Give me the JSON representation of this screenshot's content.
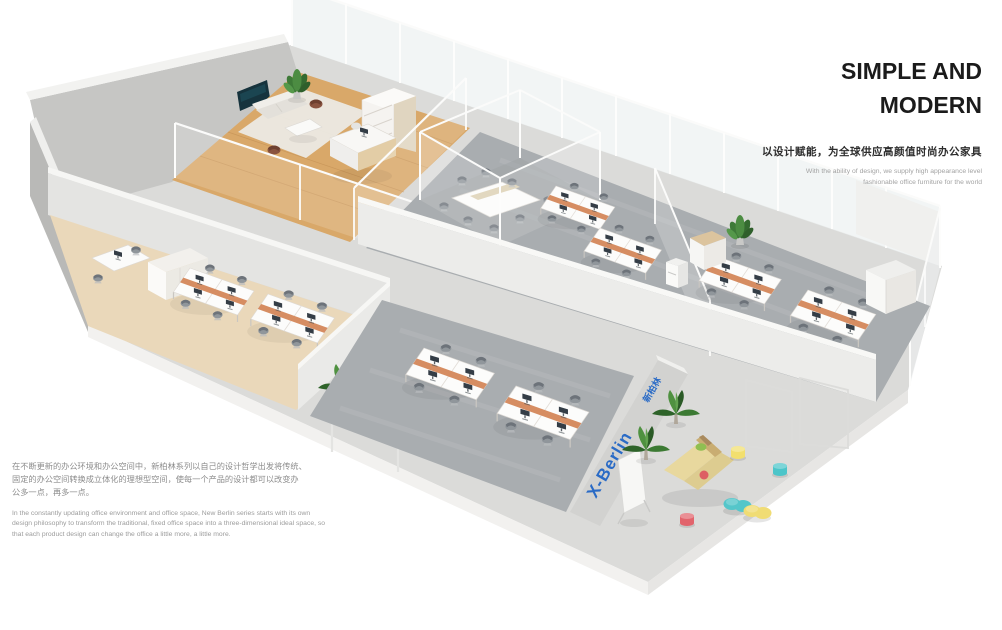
{
  "header": {
    "title_line1": "SIMPLE AND",
    "title_line2": "MODERN",
    "tagline_zh": "以设计赋能，为全球供应高颜值时尚办公家具",
    "tagline_en_line1": "With the ability of design, we supply high appearance level",
    "tagline_en_line2": "fashionable office furniture for the world"
  },
  "description": {
    "zh_lines": [
      "在不断更新的办公环境和办公空间中，新柏林系列以自己的设计哲学出发将传统、",
      "固定的办公空间转换成立体化的理想型空间，使每一个产品的设计都可以改变办",
      "公多一点，再多一点。"
    ],
    "en_lines": [
      "In the constantly updating office environment and office space, New Berlin series starts with its own",
      "design philosophy to transform the traditional, fixed office space into a three-dimensional ideal space, so",
      "that each product design can change the office a little more, a little more."
    ]
  },
  "scene": {
    "wall_brand": "X-Berlin",
    "wall_logo": "新柏林",
    "colors": {
      "brand_blue": "#2A6BC6",
      "wood_floor": "#D9A869",
      "carpet_gray": "#A9ADB0",
      "cream_floor": "#EAD8BA",
      "concrete": "#DBDBD9",
      "wall_gray": "#C6C6C4",
      "divider_orange": "#D4875A",
      "stool_yellow": "#F2DF6E",
      "stool_teal": "#4CC5C9",
      "stool_red": "#E2646C",
      "pouf_yellow": "#F0DC74",
      "pouf_teal": "#54C6CA",
      "sofa_beige": "#E8D89E",
      "plant_green": "#4E8C44",
      "tv_screen": "#16333D"
    }
  }
}
